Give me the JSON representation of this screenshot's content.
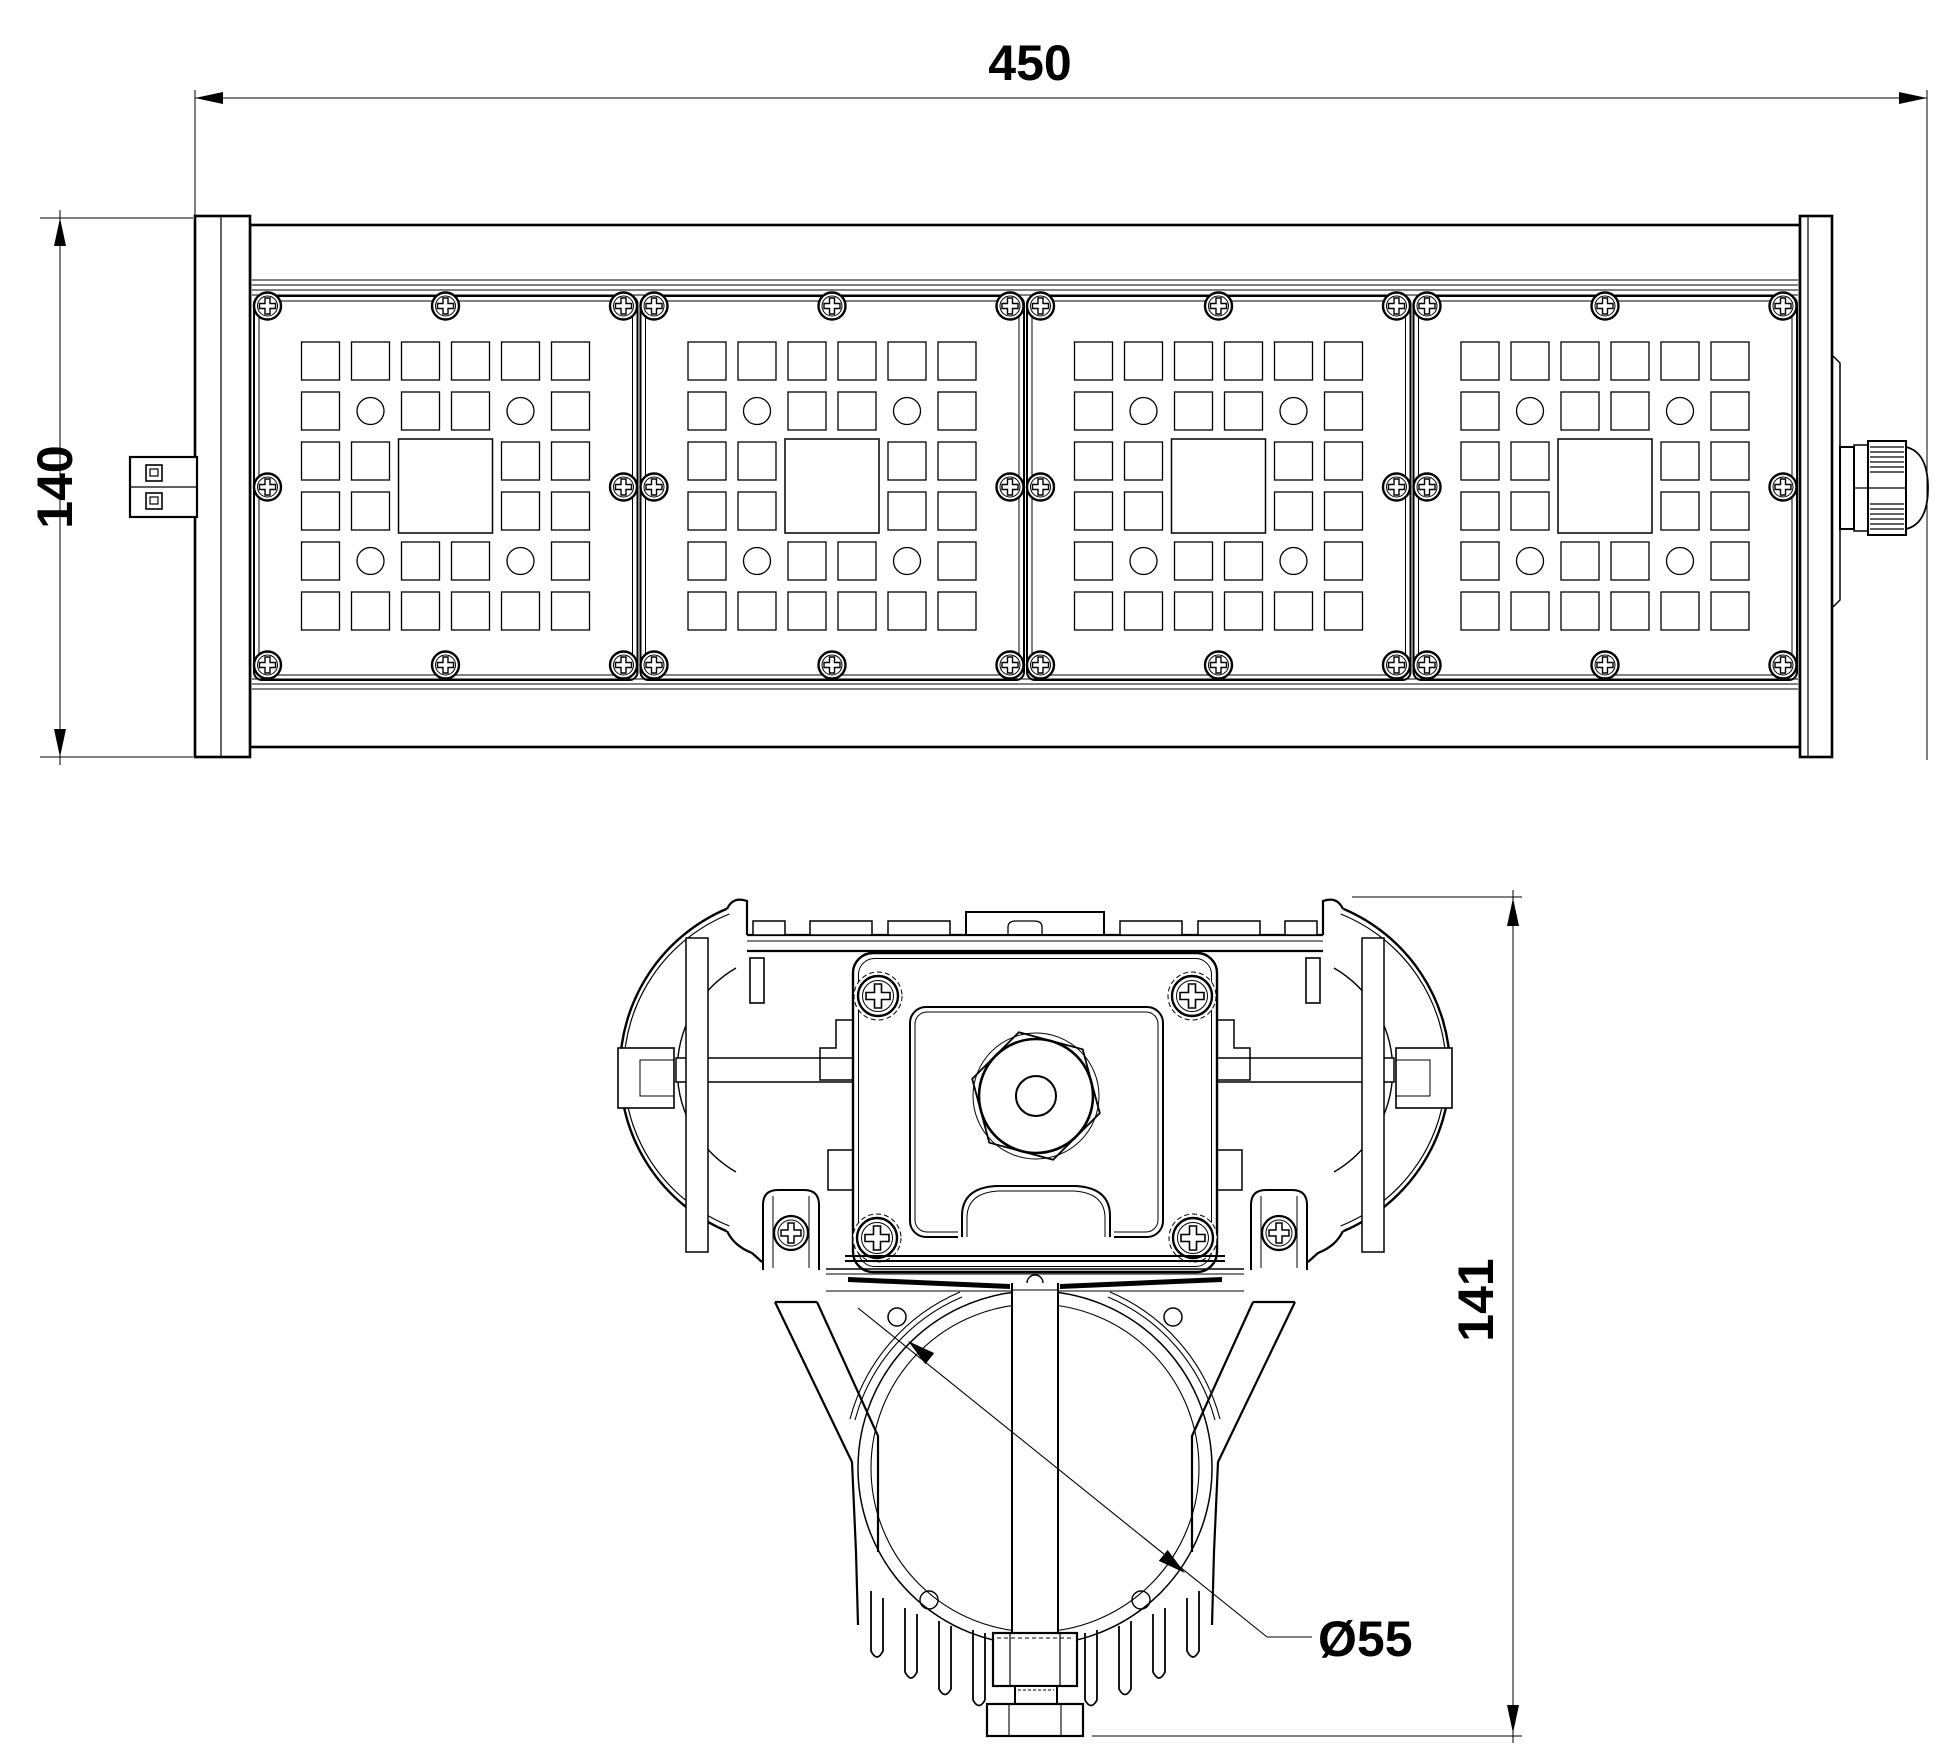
{
  "drawing": {
    "type": "technical-drawing",
    "background_color": "#ffffff",
    "line_color": "#000000",
    "dimensions": {
      "overall_length": "450",
      "overall_height": "140",
      "section_height": "141",
      "pipe_diameter": "Ø55"
    },
    "views": {
      "top_view": {
        "label": "luminaire-top-view",
        "module_count": 4,
        "lens_grid": "6x6",
        "screws_per_module": 8,
        "features": [
          "end-caps",
          "terminal-connector-left",
          "cable-gland-right"
        ]
      },
      "section_view": {
        "label": "luminaire-cross-section",
        "features": [
          "heatsink-fan-wings",
          "mounting-bracket",
          "hex-nut",
          "pipe-clamp",
          "cooling-fins"
        ],
        "bracket_screws": 4
      }
    }
  }
}
